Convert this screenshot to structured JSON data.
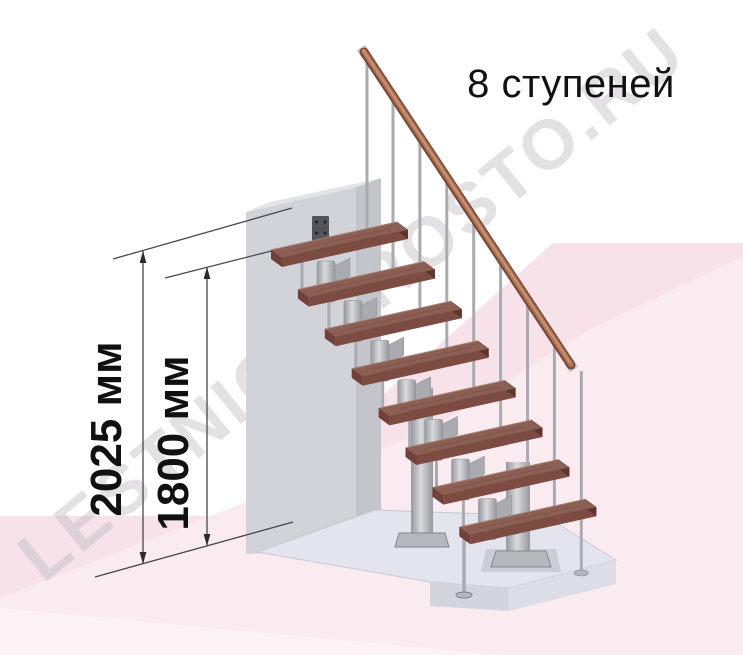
{
  "title": "8 ступеней",
  "steps_count": 8,
  "watermark": "LESTNICAPROSTO.RU",
  "dims": {
    "total": "2025 мм",
    "to_top_tread": "1800 мм"
  },
  "colors": {
    "background": "#ffffff",
    "pink": "#f7e2ea",
    "pink_light": "#faebf1",
    "pink_lighter": "#fdf3f7",
    "wall_front": "#d2d3d8",
    "wall_side": "#c4c5cb",
    "wall_top": "#e3e4e8",
    "plate": "#54555b",
    "plate_hole": "#26272b",
    "platform_top": "#e3e4ed",
    "platform_front": "#d2d4de",
    "platform_right": "#dcdde6",
    "tread_top": "#8c5f55",
    "tread_front": "#7c4c43",
    "tread_side": "#5e352d",
    "tread_left": "#6f4138",
    "tread_grain": "#714740",
    "tread_highlight": "#b08a7c",
    "metal": "#aaabb1",
    "metal_dark": "#8e8f95",
    "metal_plate": "#b7b8be",
    "rail_dark": "#7a4634",
    "rail_mid": "#aa7256",
    "rail_light": "#cf9a79",
    "cap": "#c9cbd1",
    "dim_line": "#48484c",
    "arrow": "#2b2b2b",
    "text": "#111111",
    "watermark_color": "#beb9be"
  }
}
